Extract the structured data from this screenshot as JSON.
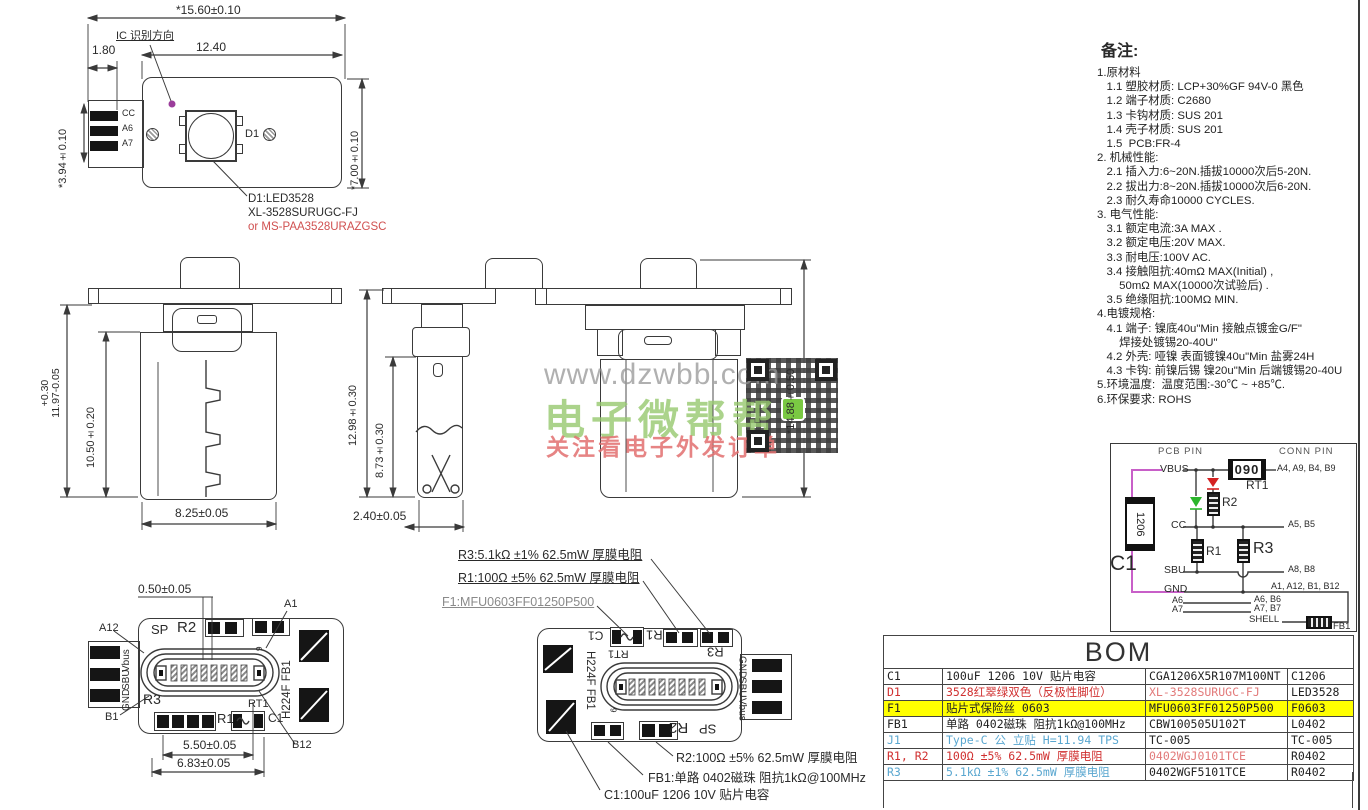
{
  "top_view": {
    "dim_overall_width": "*15.60±0.10",
    "dim_led_offset": "12.40",
    "dim_tab_width": "1.80",
    "dim_tab_height": "*3.94±0.10",
    "dim_body_height": "*7.00±0.10",
    "ic_direction_label": "IC 识别方向",
    "pad_labels": [
      "CC",
      "A6",
      "A7"
    ],
    "led_ref": "D1",
    "led_callout_1": "D1:LED3528",
    "led_callout_2": "XL-3528SURUGC-FJ",
    "led_callout_3": "or MS-PAA3528URAZGSC"
  },
  "front_view": {
    "dim_height_plus": "+0.30",
    "dim_height": "11.97-0.05",
    "dim_inner_height": "10.50±0.20",
    "dim_width": "8.25±0.05"
  },
  "side_view": {
    "dim_height": "12.98±0.30",
    "dim_inner_height": "8.73±0.30",
    "dim_width": "2.40±0.05"
  },
  "back_view": {
    "dim_height": "*14.88±0.50"
  },
  "watermark": {
    "url": "www.dzwbb.com",
    "brand": "电子微帮帮",
    "slogan": "关注看电子外发订单"
  },
  "pcb_top_view": {
    "dim_pitch": "0.50±0.05",
    "dim_pin_span": "5.50±0.05",
    "dim_pad_span": "6.83±0.05",
    "callout_a1": "A1",
    "callout_a12": "A12",
    "callout_b1": "B1",
    "callout_b12": "B12",
    "silk_sp": "SP",
    "silk_r2": "R2",
    "silk_r3": "R3",
    "silk_rt1": "RT1",
    "silk_r1": "R1",
    "silk_c1": "C1",
    "silk_h224f": "H224F FB1",
    "silk_9": "9",
    "pad_labels": [
      "Vbus",
      "SBU",
      "GND"
    ]
  },
  "pcb_bottom_view": {
    "silk_c1": "C1",
    "silk_r1": "R1",
    "silk_rt1": "RT1",
    "silk_r3": "R3",
    "silk_h224f": "H224F FB1",
    "silk_sp": "SP",
    "silk_r2": "R2",
    "silk_9": "9",
    "pad_labels": [
      "GND",
      "SBU",
      "Vbus"
    ],
    "callouts": {
      "r3": "R3:5.1kΩ ±1% 62.5mW 厚膜电阻",
      "r1": "R1:100Ω ±5% 62.5mW 厚膜电阻",
      "f1": "F1:MFU0603FF01250P500",
      "r2": "R2:100Ω ±5% 62.5mW 厚膜电阻",
      "fb1": "FB1:单路 0402磁珠 阻抗1kΩ@100MHz",
      "c1": "C1:100uF 1206 10V 贴片电容"
    }
  },
  "notes": {
    "title": "备注:",
    "lines": [
      "1.原材料",
      "   1.1 塑胶材质: LCP+30%GF 94V-0 黑色",
      "   1.2 端子材质: C2680",
      "   1.3 卡钩材质: SUS 201",
      "   1.4 壳子材质: SUS 201",
      "   1.5  PCB:FR-4",
      "2. 机械性能:",
      "   2.1 插入力:6~20N.插拔10000次后5-20N.",
      "   2.2 拔出力:8~20N.插拔10000次后6-20N.",
      "   2.3 耐久寿命10000 CYCLES.",
      "3. 电气性能:",
      "   3.1 额定电流:3A MAX .",
      "   3.2 额定电压:20V MAX.",
      "   3.3 耐电压:100V AC.",
      "   3.4 接触阻抗:40mΩ MAX(Initial) ,",
      "       50mΩ MAX(10000次试验后) .",
      "   3.5 绝缘阻抗:100MΩ MIN.",
      "4.电镀规格:",
      "   4.1 端子: 镍底40u\"Min 接触点镀金G/F\"",
      "       焊接处镀锡20-40U\"",
      "   4.2 外壳: 哑镍 表面镀镍40u\"Min 盐雾24H",
      "   4.3 卡钩: 前镍后锡 镍20u\"Min 后端镀锡20-40U",
      "5.环境温度:  温度范围:-30℃ ~ +85℃.",
      "6.环保要求: ROHS"
    ]
  },
  "schematic": {
    "pcb_pin_header": "PCB PIN",
    "conn_pin_header": "CONN PIN",
    "vbus": "VBUS",
    "cc": "CC",
    "sbu": "SBU",
    "gnd": "GND",
    "a6": "A6",
    "a7": "A7",
    "shell": "SHELL",
    "conn_vbus": "A4, A9, B4, B9",
    "conn_cc": "A5, B5",
    "conn_sbu": "A8, B8",
    "conn_gnd": "A1, A12, B1, B12",
    "conn_a6": "A6, B6",
    "conn_a7": "A7, B7",
    "rt1_ref": "RT1",
    "rt1_marking": "090",
    "r1_ref": "R1",
    "r2_ref": "R2",
    "r3_ref": "R3",
    "c1_ref": "C1",
    "c1_marking": "1206",
    "fb1_ref": "FB1",
    "colors": {
      "wire": "#3a3a3a",
      "c1_wire": "#c85fc8",
      "led_red": "#d42222",
      "led_green": "#2bb52b"
    }
  },
  "bom": {
    "title": "BOM",
    "highlight_color": "#ffff00",
    "rows": [
      {
        "ref": "C1",
        "desc": "100uF 1206 10V 贴片电容",
        "part": "CGA1206X5R107M100NT",
        "pkg": "C1206",
        "highlight": false,
        "cell_colors": [
          "#222222",
          "#222222",
          "#222222",
          "#222222"
        ]
      },
      {
        "ref": "D1",
        "desc": "3528红翠绿双色（反极性脚位）",
        "part": "XL-3528SURUGC-FJ",
        "pkg": "LED3528",
        "highlight": false,
        "cell_colors": [
          "#d03030",
          "#d03030",
          "#e27a7a",
          "#222222"
        ]
      },
      {
        "ref": "F1",
        "desc": "贴片式保险丝 0603",
        "part": "MFU0603FF01250P500",
        "pkg": "F0603",
        "highlight": true,
        "cell_colors": [
          "#222222",
          "#222222",
          "#222222",
          "#222222"
        ]
      },
      {
        "ref": "FB1",
        "desc": "单路 0402磁珠 阻抗1kΩ@100MHz",
        "part": "CBW100505U102T",
        "pkg": "L0402",
        "highlight": false,
        "cell_colors": [
          "#222222",
          "#222222",
          "#222222",
          "#222222"
        ]
      },
      {
        "ref": "J1",
        "desc": "Type-C 公 立贴 H=11.94 TPS",
        "part": "TC-005",
        "pkg": "TC-005",
        "highlight": false,
        "cell_colors": [
          "#5aa7d0",
          "#5aa7d0",
          "#222222",
          "#222222"
        ]
      },
      {
        "ref": "R1, R2",
        "desc": "100Ω ±5% 62.5mW 厚膜电阻",
        "part": "0402WGJ0101TCE",
        "pkg": "R0402",
        "highlight": false,
        "cell_colors": [
          "#d03030",
          "#d03030",
          "#e27a7a",
          "#222222"
        ]
      },
      {
        "ref": "R3",
        "desc": "5.1kΩ ±1% 62.5mW 厚膜电阻",
        "part": "0402WGF5101TCE",
        "pkg": "R0402",
        "highlight": false,
        "cell_colors": [
          "#5aa7d0",
          "#5aa7d0",
          "#222222",
          "#222222"
        ]
      }
    ]
  }
}
